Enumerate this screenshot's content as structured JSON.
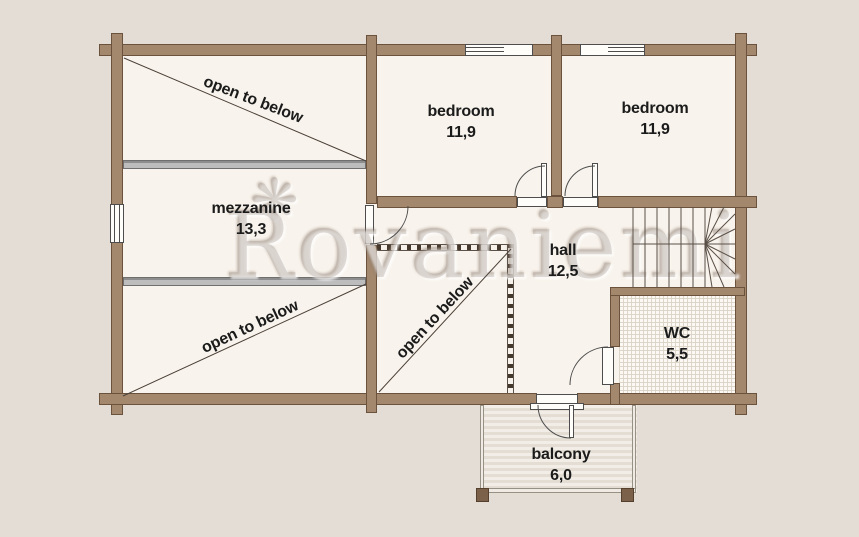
{
  "watermark": {
    "text": "Rovaniemi",
    "logo": "snowflake-icon"
  },
  "rooms": [
    {
      "id": "open-top-left",
      "label": "open to below"
    },
    {
      "id": "mezzanine",
      "label": "mezzanine",
      "area": "13,3"
    },
    {
      "id": "open-bottom-left",
      "label": "open to below"
    },
    {
      "id": "open-middle",
      "label": "open to below"
    },
    {
      "id": "bedroom-left",
      "label": "bedroom",
      "area": "11,9"
    },
    {
      "id": "bedroom-right",
      "label": "bedroom",
      "area": "11,9"
    },
    {
      "id": "hall",
      "label": "hall",
      "area": "12,5"
    },
    {
      "id": "wc",
      "label": "WC",
      "area": "5,5"
    },
    {
      "id": "balcony",
      "label": "balcony",
      "area": "6,0"
    }
  ],
  "colors": {
    "background": "#e3ddd6",
    "floor": "#f8f3ec",
    "wall": "#a3886e",
    "wall_border": "#6a523c",
    "beam": "#bdbdbd",
    "line": "#4d4d4d",
    "text": "#1b1b1b",
    "watermark": "#b7ab9d"
  }
}
